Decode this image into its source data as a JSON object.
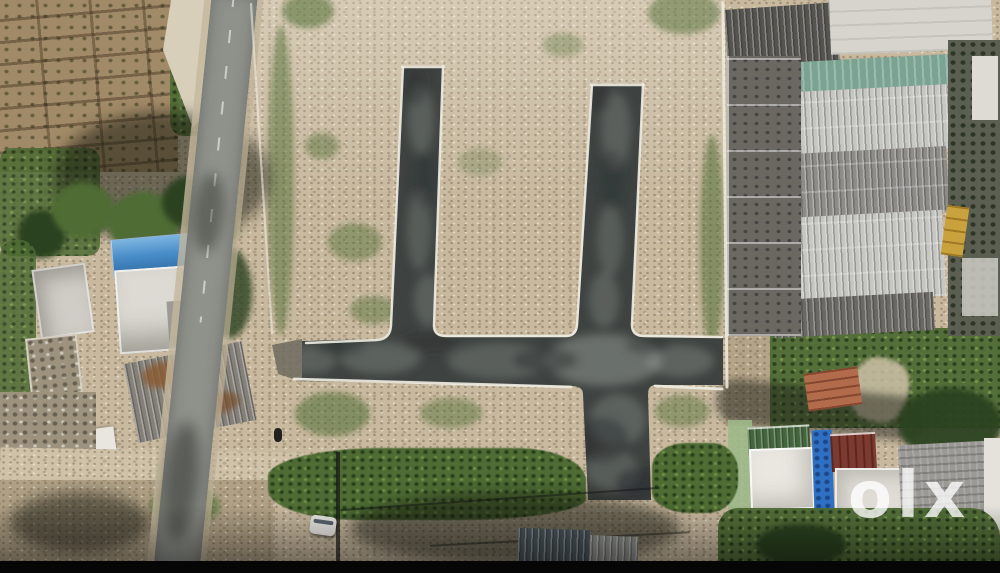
{
  "watermark": {
    "text": "olx"
  },
  "colors": {
    "dirt": "#c8b99f",
    "dirtDark": "#a79273",
    "farm": "#a18a67",
    "asphalt": "#3e4341",
    "asphaltLight": "#9ba19b",
    "curb": "#eeece1",
    "street": "#8f918b",
    "veg": "#4e6c34",
    "vegDark": "#2b4220",
    "blueRoof": "#4a8ec9",
    "tealRoof": "#7ba392",
    "silverRoof": "#c6c6c2",
    "midGrayRoof": "#8e8c88",
    "darkSlateRoof": "#56544f",
    "concrete": "#d6d4cd",
    "terracotta": "#b26b4b",
    "redRoof": "#7d3a31",
    "greenRoof": "#44663c",
    "paleGreenWall": "#9db98a",
    "blueTarp": "#2f70c2",
    "grayTile": "#9b9995",
    "yellowCrate": "#c9a23d",
    "letterbox": "#060606"
  }
}
